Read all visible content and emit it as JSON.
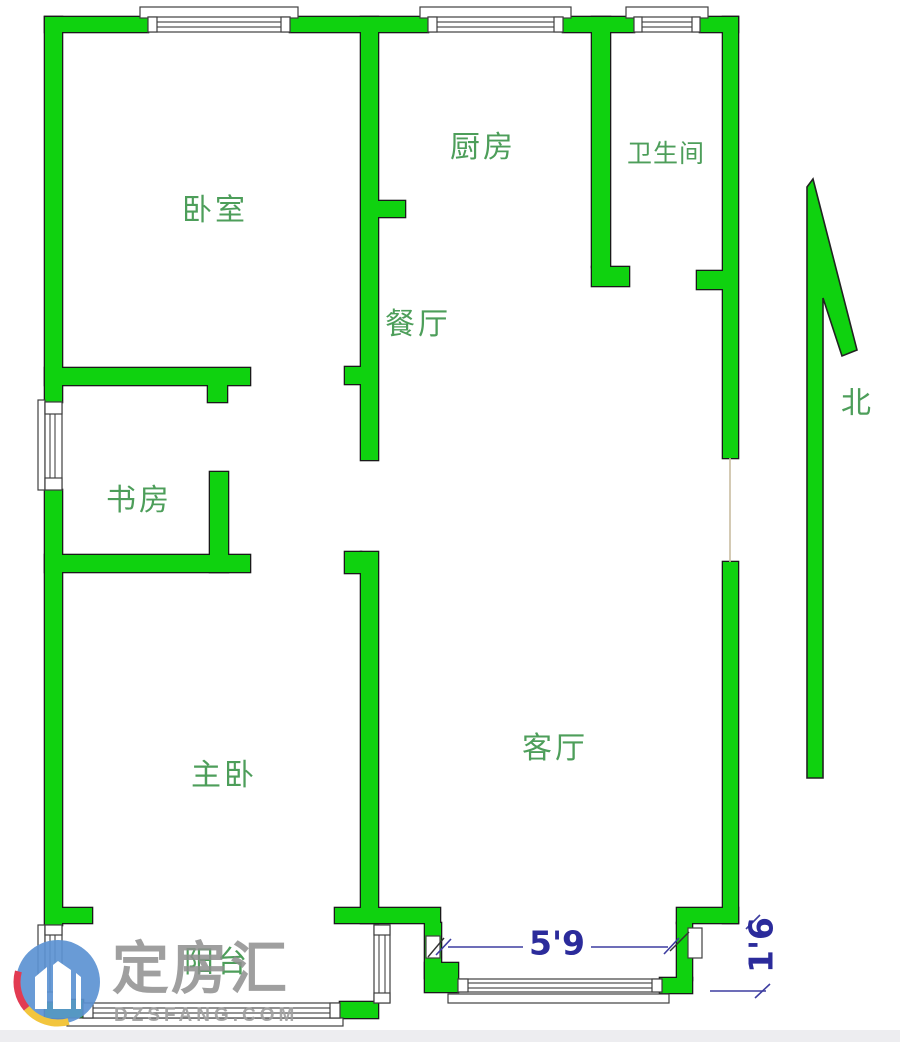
{
  "floorplan": {
    "rooms": [
      {
        "id": "bedroom",
        "label": "卧室"
      },
      {
        "id": "kitchen",
        "label": "厨房"
      },
      {
        "id": "bathroom",
        "label": "卫生间"
      },
      {
        "id": "dining-room",
        "label": "餐厅"
      },
      {
        "id": "study",
        "label": "书房"
      },
      {
        "id": "master-bedroom",
        "label": "主卧"
      },
      {
        "id": "living-room",
        "label": "客厅"
      },
      {
        "id": "balcony",
        "label": "阳台"
      }
    ],
    "compass": {
      "label": "北",
      "icon": "north-arrow"
    },
    "dimensions": [
      {
        "id": "living-room-window-width",
        "value": "5'9"
      },
      {
        "id": "entry-door-width",
        "value": "1'6"
      }
    ],
    "colors": {
      "wall": "#0fd20f",
      "wall_outline": "#1a1a1a",
      "room_label": "#4d9e5a",
      "dimension": "#2b2b9b"
    }
  },
  "watermark": {
    "brand": "定房汇",
    "domain": "DZSFANG.COM"
  }
}
